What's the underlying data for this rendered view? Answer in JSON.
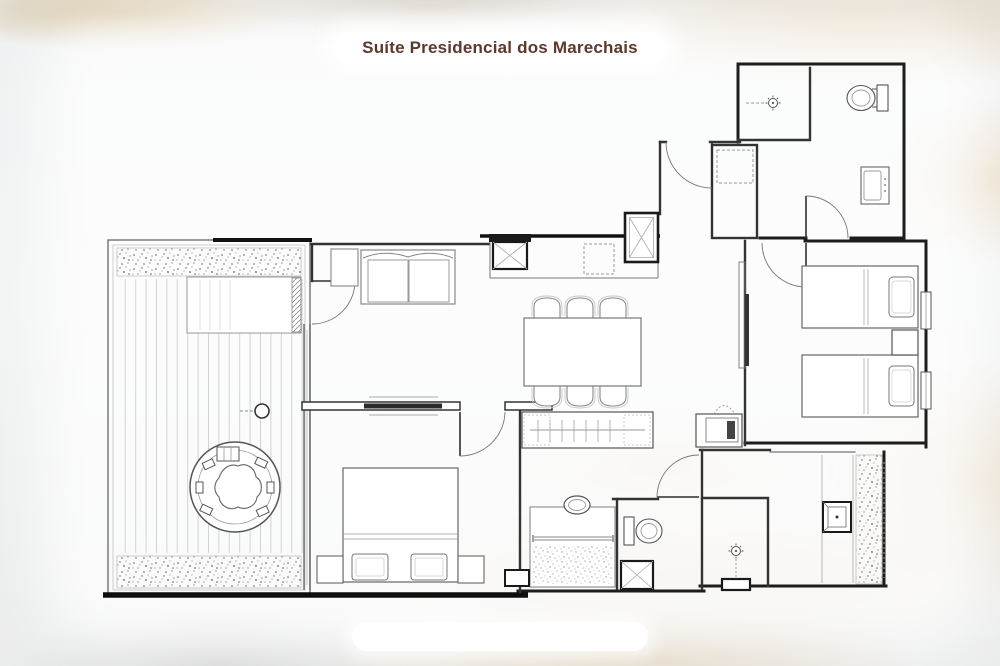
{
  "header": {
    "title": "Suíte Presidencial dos Marechais"
  },
  "colors": {
    "title_text": "#5d392b",
    "pill_bg": "#ffffff",
    "canvas_bg": "#eef0f1",
    "texture_gold": "#d9ba8a",
    "wall_dark": "#1d1d1d",
    "wall_medium": "#444444",
    "furniture_line": "#888888"
  },
  "footer": {
    "pill_label": ""
  },
  "floor_plan": {
    "type": "architectural-plan",
    "rooms": [
      {
        "name": "terrace-deck"
      },
      {
        "name": "living-room"
      },
      {
        "name": "dining-kitchenette"
      },
      {
        "name": "entry-hall"
      },
      {
        "name": "master-bedroom"
      },
      {
        "name": "twin-bedroom"
      },
      {
        "name": "bathroom-top-right"
      },
      {
        "name": "bathroom-bottom-center"
      },
      {
        "name": "bathroom-bottom-right"
      },
      {
        "name": "wardrobe-vestibule"
      },
      {
        "name": "luggage-closet"
      }
    ],
    "fixtures": [
      "planter-strip",
      "round-jacuzzi",
      "jacuzzi-steps",
      "outdoor-column",
      "sliding-glass-door",
      "sofa",
      "side-table",
      "tv-partition",
      "king-bed",
      "nightstand",
      "dining-table-6-chairs",
      "kitchen-sink-unit",
      "refrigerator",
      "service-shaft",
      "entry-door",
      "luggage-rack",
      "shower-head",
      "toilet",
      "vanity-basin",
      "twin-bed",
      "bedside-table",
      "window",
      "wardrobe-hangers",
      "minibar-niche",
      "vessel-sink-counter",
      "towel-rail",
      "decorative-gravel",
      "shower-stall",
      "square-basin",
      "vertical-garden"
    ]
  }
}
